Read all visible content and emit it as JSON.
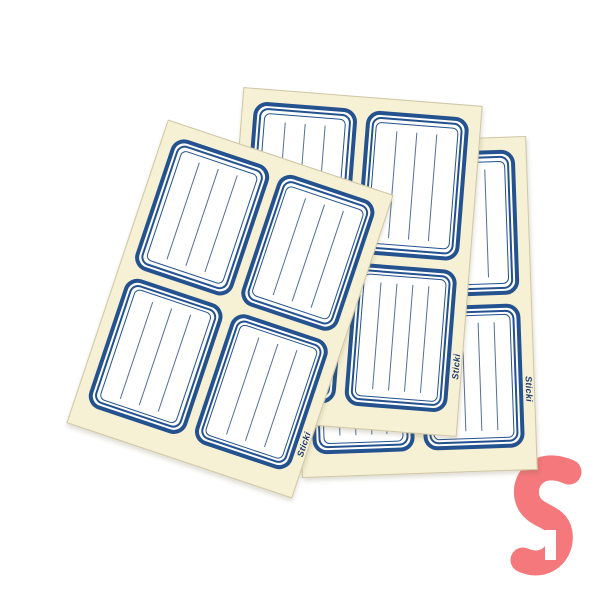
{
  "page": {
    "background": "#ffffff",
    "width": 600,
    "height": 600
  },
  "brand": {
    "name": "Sticki"
  },
  "colors": {
    "sheet_background": "#f6f0d4",
    "sheet_edge": "#cfc7a6",
    "label_border_blue": "#24528f",
    "writing_line_blue": "#546e9d",
    "brand_text_blue": "#1b3a73",
    "logo_pink": "#f4787c"
  },
  "product": {
    "description": "Three overlapping cream sheets of blank blue-bordered writing labels, 4 labels per sheet, brand Sticki, pink S logo at bottom right"
  },
  "sheets": [
    {
      "id": "right-sheet",
      "x": 296,
      "y": 140,
      "w": 236,
      "h": 334,
      "rotate": -2,
      "z": 1,
      "brand_label": {
        "edge": "right",
        "top_pct": 76,
        "rotation": 90
      },
      "labels": [
        {
          "lines": 3
        },
        {
          "lines": 3
        },
        {
          "lines": 4
        },
        {
          "lines": 4
        }
      ]
    },
    {
      "id": "middle-sheet",
      "x": 230,
      "y": 96,
      "w": 240,
      "h": 332,
      "rotate": 4.5,
      "z": 2,
      "brand_label": {
        "edge": "right",
        "top_pct": 79,
        "rotation": -90
      },
      "labels": [
        {
          "lines": 3
        },
        {
          "lines": 3
        },
        {
          "lines": 4
        },
        {
          "lines": 4
        }
      ]
    },
    {
      "id": "left-sheet",
      "x": 111,
      "y": 149,
      "w": 238,
      "h": 320,
      "rotate": 18.5,
      "z": 3,
      "brand_label": {
        "edge": "right",
        "top_pct": 83,
        "rotation": -90
      },
      "labels": [
        {
          "lines": 3
        },
        {
          "lines": 3
        },
        {
          "lines": 3
        },
        {
          "lines": 3
        }
      ]
    }
  ]
}
